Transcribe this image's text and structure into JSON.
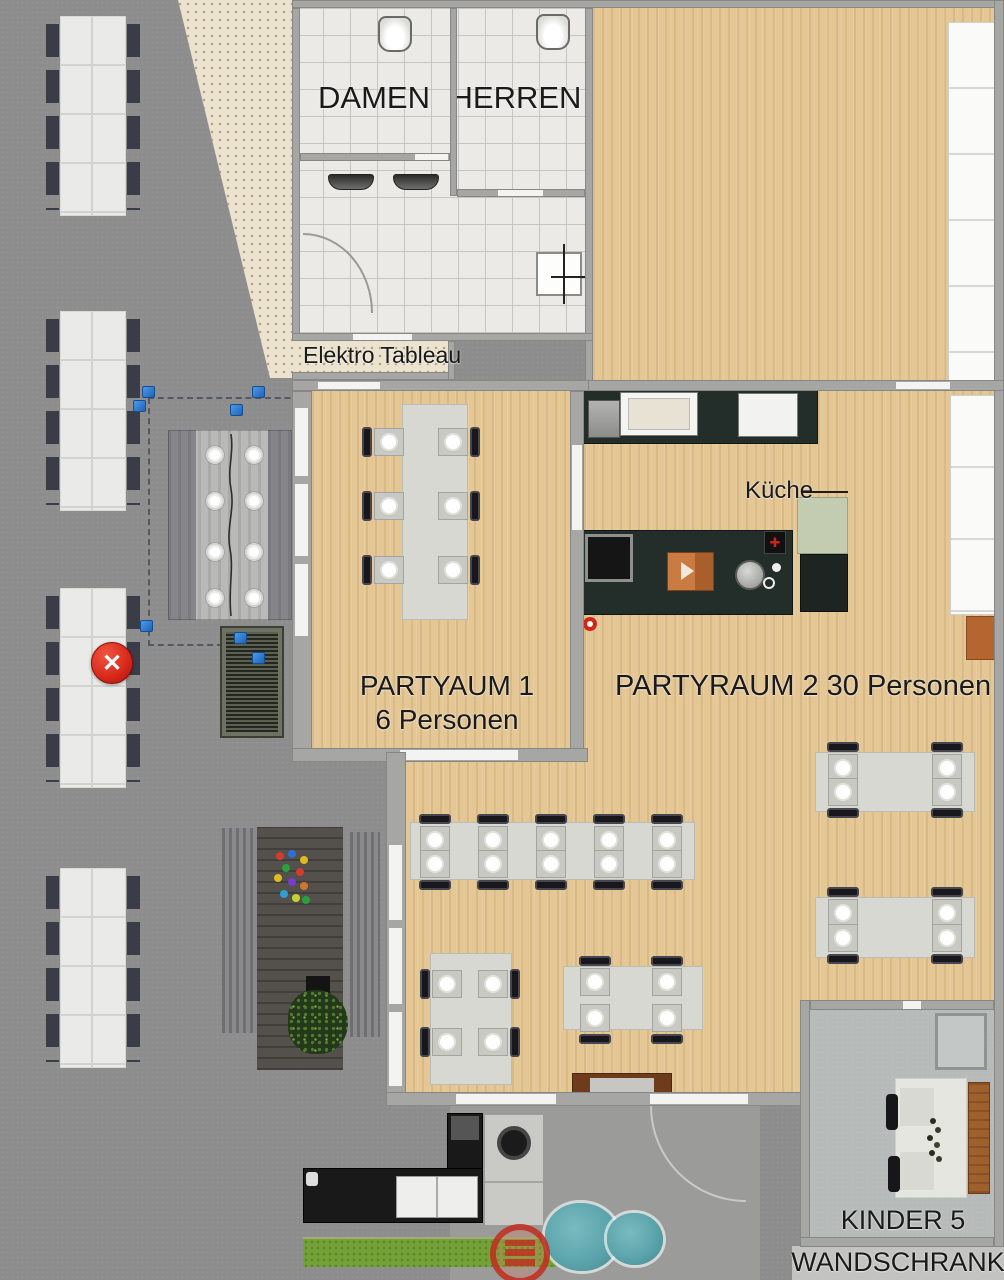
{
  "labels": {
    "damen": "DAMEN",
    "herren": "HERREN",
    "elektro_tableau": "Elektro Tableau",
    "kueche": "Küche",
    "partyraum1_line1": "PARTYAUM 1",
    "partyraum1_line2": "6 Personen",
    "partyraum2": "PARTYRAUM 2 30 Personen",
    "kinder": "KINDER 5",
    "wandschrank": "WANDSCHRANK"
  },
  "markers": {
    "delete_symbol": "✕",
    "delete_color": "#d7281a",
    "handle_color": "#2f80d9"
  },
  "colors": {
    "wood_floor": "#e4c795",
    "pavement": "#8d8d8d",
    "bathroom_tile": "#eceae6",
    "patio": "#ebe3cf",
    "kitchen_counter": "#232e2b",
    "kitchen_accent_green": "#c3ccb0",
    "grass": "#74a238",
    "bush": "#5ca4ac",
    "sideboard_brown": "#6e3c1c"
  }
}
